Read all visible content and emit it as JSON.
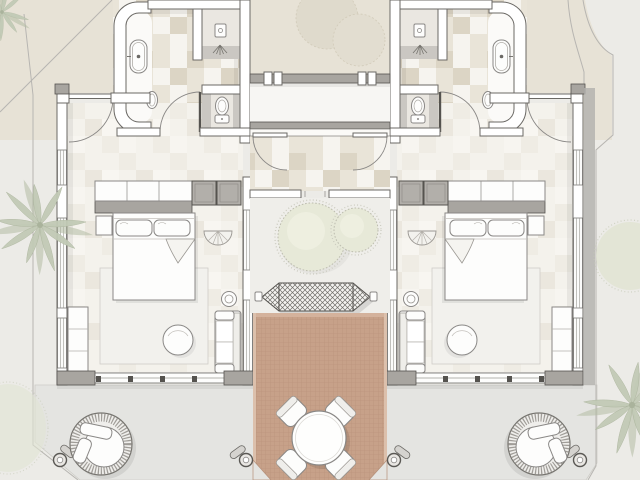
{
  "colors": {
    "background": "#ecebe7",
    "sand": "#e7e2d6",
    "paving": "#e4e4e1",
    "paving_edge": "#cdccc7",
    "wall_fill": "#ffffff",
    "wall_gray": "#a8a5a0",
    "wall_dark": "#6b6965",
    "wall_cap": "#55534f",
    "building_shadow": "#b2b0ac",
    "tile_light": "#f6f4ef",
    "tile_mid": "#e9e4d8",
    "tile_dark": "#dcd5c5",
    "floor_pale": "#f4f2ec",
    "deck": "#c7a189",
    "deck_edge": "#dcc0ac",
    "garden_green": "#e7e9d8",
    "garden_fringe": "#bcbcae",
    "palm_green": "#c2cab6",
    "furniture_white": "#fdfdfc",
    "outline": "#8a8886",
    "rug": "#f2f1ed",
    "wet_floor": "#cac7c2",
    "shower_floor": "#eae7e1"
  },
  "site": {
    "plan_type": "resort-guest-suite-floor-plan",
    "boundary": "angled-fence-lines",
    "vegetation": [
      "palm-tree-left",
      "palm-tree-bottom-right",
      "palm-tree-top-left-corner",
      "bush-right",
      "shrub-bottom-left",
      "garden-shrub-large",
      "garden-shrub-small",
      "courtyard-tree",
      "courtyard-tree"
    ]
  },
  "units": {
    "count": 2,
    "layout": "mirrored-pair",
    "bathroom_fixtures": [
      "bathtub",
      "wash-basin",
      "walk-in-shower",
      "toilet"
    ],
    "bedroom_furniture": [
      "double-bed",
      "pillow",
      "pillow",
      "nightstand",
      "console-shelf",
      "wardrobe-unit",
      "wardrobe-unit",
      "fan-stool",
      "area-rug",
      "round-pouf",
      "window-bench",
      "lounge-sofa",
      "round-side-table"
    ],
    "doors": [
      "entry-door",
      "bathroom-door",
      "vestibule-door",
      "sliding-glass-door"
    ]
  },
  "central_courtyard": {
    "zones": [
      "entry-court",
      "breezeway",
      "vestibule",
      "garden",
      "hammock",
      "timber-deck"
    ],
    "hammock_count": 1,
    "dining": {
      "tables": 1,
      "chairs": 4
    },
    "bollard_lights": 4
  },
  "outdoor": {
    "round_daybeds": 2,
    "terrace": "paved-apron"
  }
}
